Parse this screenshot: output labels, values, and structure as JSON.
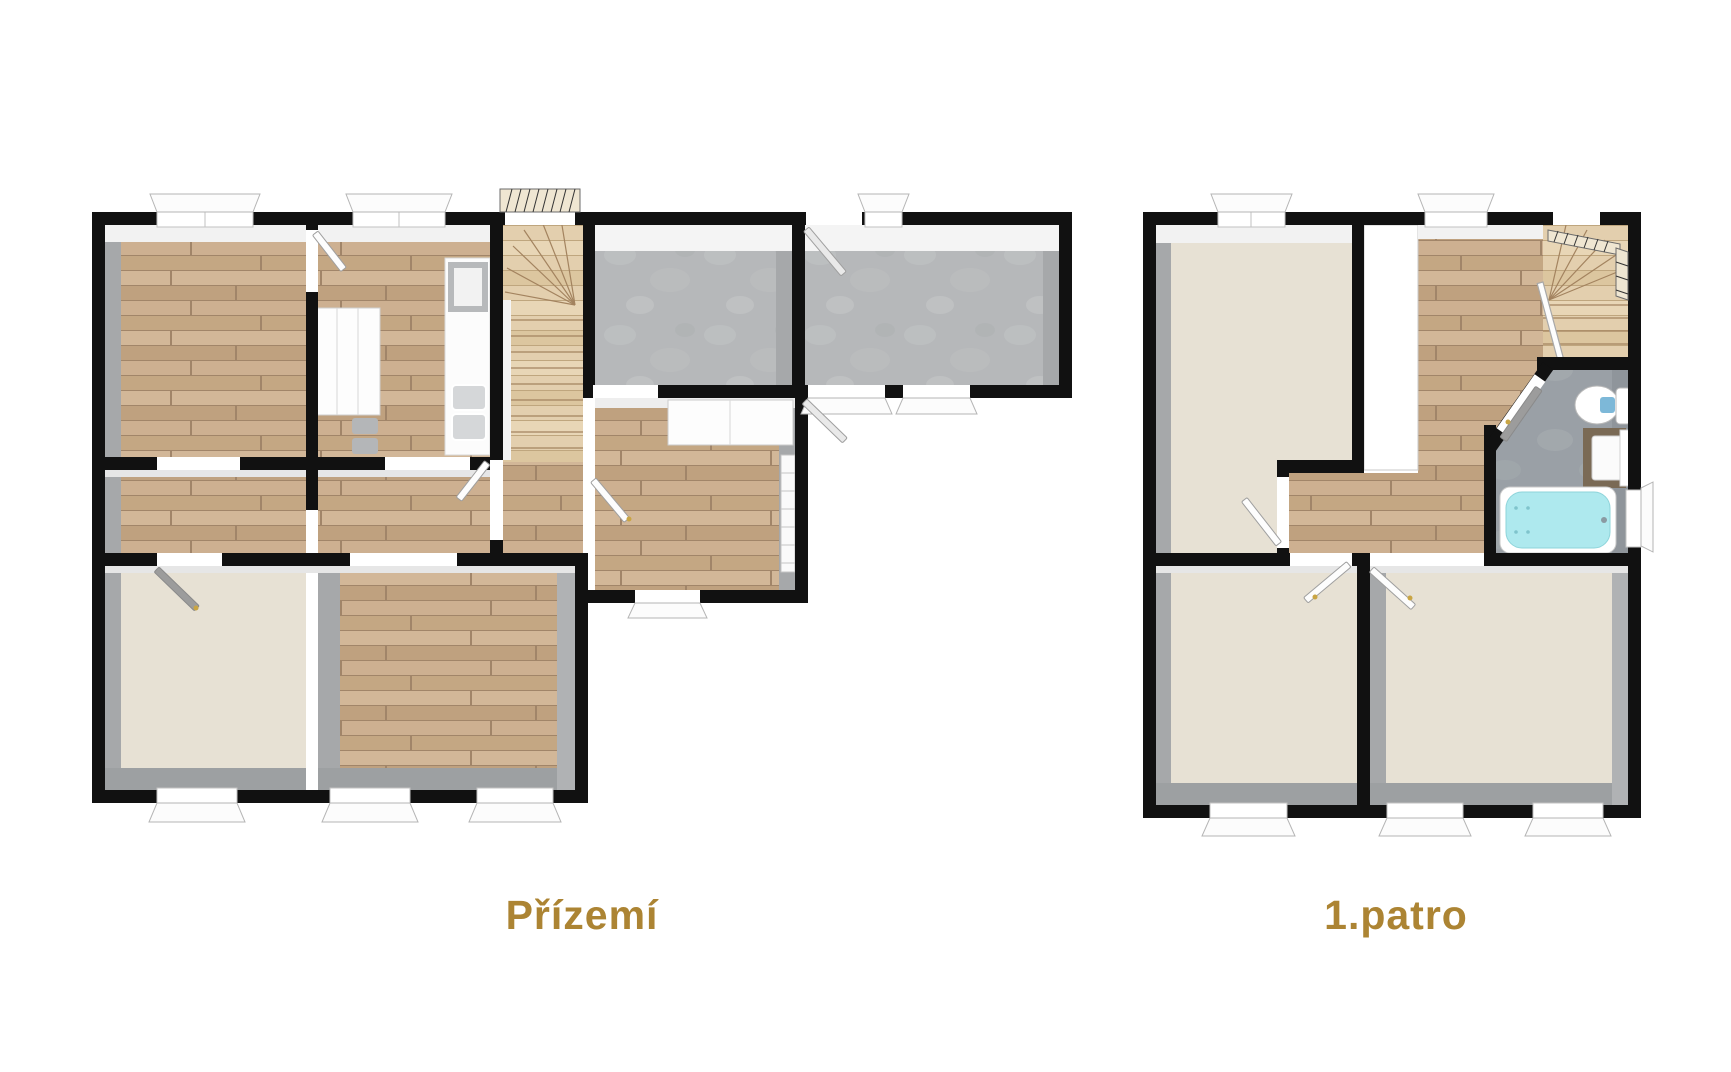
{
  "image_type": "real-estate floor plan, 3D top-down render, two storeys",
  "plans": [
    {
      "id": "ground-floor",
      "label": "Přízemí",
      "rooms": [
        {
          "name": "bedroom-top-left",
          "floor": "wood"
        },
        {
          "name": "kitchen",
          "floor": "wood",
          "fixtures": [
            "counter",
            "cooktop",
            "sink",
            "cabinet",
            "chairs"
          ]
        },
        {
          "name": "staircase",
          "floor": "light-wood",
          "fixtures": [
            "winder-stairs",
            "railing"
          ]
        },
        {
          "name": "garage-left",
          "floor": "concrete"
        },
        {
          "name": "garage-right",
          "floor": "concrete"
        },
        {
          "name": "hallway",
          "floor": "wood",
          "fixtures": [
            "sideboard",
            "tall-cabinet",
            "entry-door"
          ]
        },
        {
          "name": "corridor",
          "floor": "wood"
        },
        {
          "name": "bedroom-bottom-left",
          "floor": "carpet-beige"
        },
        {
          "name": "living-room",
          "floor": "wood"
        }
      ]
    },
    {
      "id": "first-floor",
      "label": "1.patro",
      "rooms": [
        {
          "name": "bedroom-large",
          "floor": "carpet-beige"
        },
        {
          "name": "landing-hall",
          "floor": "wood",
          "fixtures": [
            "built-in-closet"
          ]
        },
        {
          "name": "staircase",
          "floor": "light-wood",
          "fixtures": [
            "winder-stairs",
            "railing"
          ]
        },
        {
          "name": "bathroom",
          "floor": "tile-gray",
          "fixtures": [
            "bathtub",
            "toilet",
            "vanity-sink"
          ]
        },
        {
          "name": "bedroom-bottom-left",
          "floor": "carpet-beige"
        },
        {
          "name": "bedroom-bottom-right",
          "floor": "carpet-beige"
        }
      ]
    }
  ],
  "colors": {
    "background": "#ffffff",
    "wall": "#111111",
    "wood": "#c8aa89",
    "wood_light": "#e3cfae",
    "concrete": "#b6b8ba",
    "carpet": "#e7e1d4",
    "bath_tile": "#9aa0a6",
    "bathtub": "#aee9ee",
    "fixture_white": "#fbfbfb",
    "shadow": "#a6a8aa",
    "frame": "#b5b5b5",
    "label": "#ac8433"
  }
}
